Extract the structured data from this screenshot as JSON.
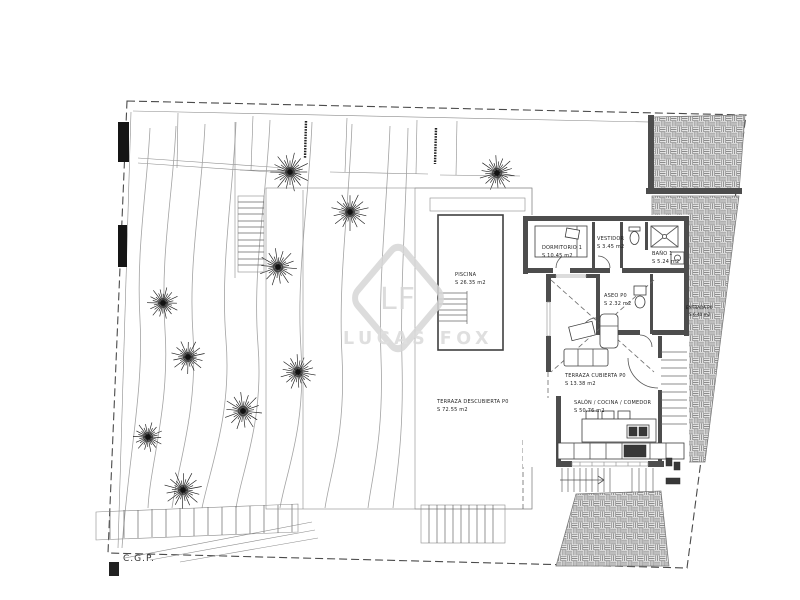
{
  "plan": {
    "rooms": {
      "piscina": {
        "label": "PISCINA",
        "area": "S 26.35 m2"
      },
      "dormitorio1": {
        "label": "DORMITORIO 1",
        "area": "S 10.45 m2"
      },
      "vestidor": {
        "label": "VESTIDOR",
        "area": "S 3.45 m2"
      },
      "bano1": {
        "label": "BAÑO 1",
        "area": "S 5.24 m2"
      },
      "aseo": {
        "label": "ASEO P0",
        "area": "S 2.32 m2"
      },
      "terraza_cubierta": {
        "label": "TERRAZA CUBIERTA P0",
        "area": "S 13.38 m2"
      },
      "salon_cocina_comedor": {
        "label": "SALÓN / COCINA / COMEDOR",
        "area": "S 50.76 m2"
      },
      "terraza_descubierta": {
        "label": "TERRAZA DESCUBIERTA P0",
        "area": "S 72.55 m2"
      },
      "entrada": {
        "label": "ENTRADA P0",
        "area": "S 6.40 m2"
      }
    },
    "annotations": {
      "cgp": "C.G.P."
    },
    "watermark": {
      "monogram": "LF",
      "brand": "LUCAS FOX"
    },
    "site": {
      "trees": [
        [
          290,
          172,
          21
        ],
        [
          350,
          212,
          19
        ],
        [
          497,
          173,
          19
        ],
        [
          278,
          267,
          19
        ],
        [
          163,
          303,
          17
        ],
        [
          188,
          357,
          17
        ],
        [
          298,
          372,
          19
        ],
        [
          243,
          411,
          19
        ],
        [
          148,
          437,
          16
        ],
        [
          183,
          490,
          19
        ]
      ]
    },
    "colors": {
      "background": "#ffffff",
      "wall": "#4d4d4d",
      "line": "#555555",
      "contour": "#a3a3a3",
      "hatch": "#8a8a8a",
      "watermark": "#d7d7d7",
      "text": "#1f1f1f"
    }
  }
}
